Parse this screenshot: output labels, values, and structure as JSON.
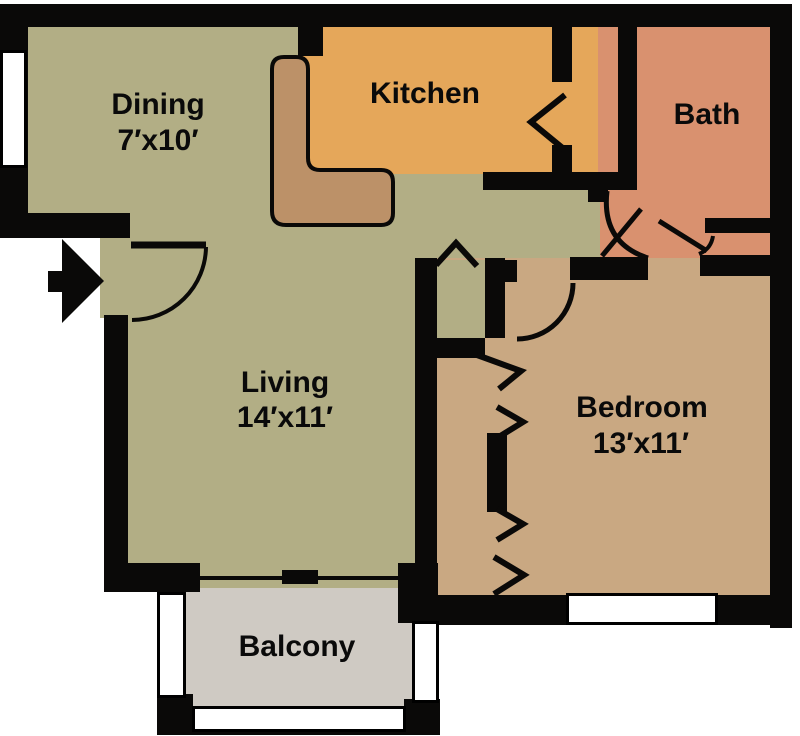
{
  "plan": {
    "title": "Apartment Floor Plan",
    "rooms": [
      {
        "name": "Dining",
        "dims": "7′x10′",
        "color": "#b2ae85"
      },
      {
        "name": "Kitchen",
        "dims": "",
        "color": "#e5a75a"
      },
      {
        "name": "Bath",
        "dims": "",
        "color": "#d9916f"
      },
      {
        "name": "Living",
        "dims": "14′x11′",
        "color": "#b2ae85"
      },
      {
        "name": "Bedroom",
        "dims": "13′x11′",
        "color": "#c9a882"
      },
      {
        "name": "Balcony",
        "dims": "",
        "color": "#cfcac3"
      }
    ],
    "counter_color": "#bc9168",
    "wall_color": "#0a0908",
    "window_color": "#ffffff",
    "icons": {
      "entry_arrow": "entry-direction-arrow",
      "door_arcs": "door-swing-arc",
      "chevrons": "bifold-door"
    }
  }
}
